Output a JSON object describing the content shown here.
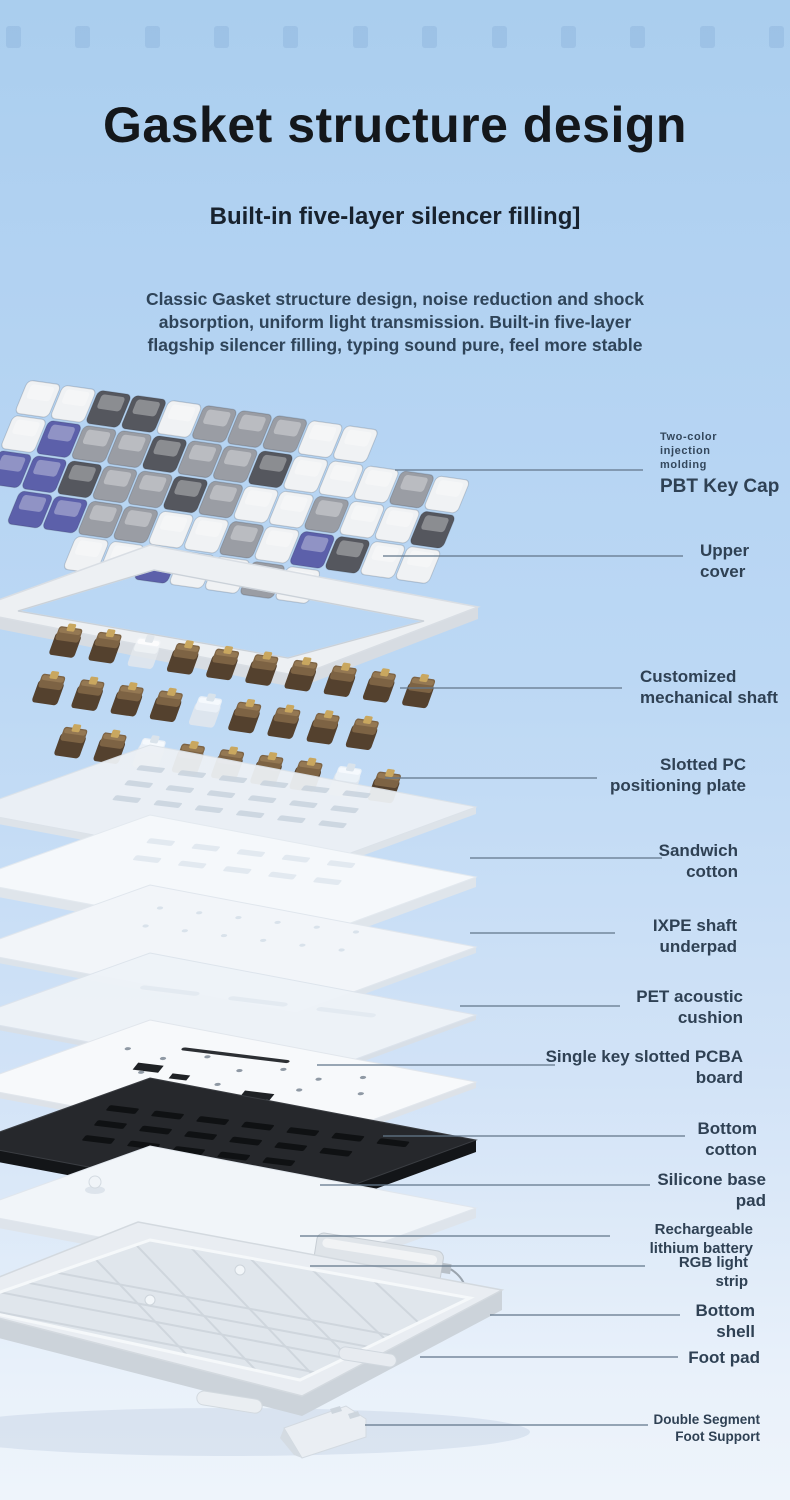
{
  "page": {
    "title": "Gasket structure design",
    "subtitle": "Built-in five-layer silencer filling]",
    "description": [
      "Classic Gasket structure design, noise reduction and shock",
      "absorption, uniform light transmission. Built-in five-layer",
      "flagship silencer filling, typing sound pure, feel more stable"
    ]
  },
  "diagram": {
    "subject": "Exploded view of gasket-mount mechanical keyboard layers",
    "callouts": [
      {
        "note": "Two-color\ninjection\nmolding",
        "text": "PBT Key Cap"
      },
      {
        "text": "Upper\ncover"
      },
      {
        "text": "Customized\nmechanical shaft"
      },
      {
        "text": "Slotted PC\npositioning plate"
      },
      {
        "text": "Sandwich\ncotton"
      },
      {
        "text": "IXPE shaft\nunderpad"
      },
      {
        "text": "PET acoustic\ncushion"
      },
      {
        "text": "Single key slotted PCBA\nboard"
      },
      {
        "text": "Bottom\ncotton"
      },
      {
        "text": "Silicone base\npad"
      },
      {
        "text": "Rechargeable\nlithium battery"
      },
      {
        "text": "RGB light\nstrip"
      },
      {
        "text": "Bottom\nshell"
      },
      {
        "text": "Foot pad"
      },
      {
        "text": "Double Segment\nFoot Support"
      }
    ]
  },
  "colors": {
    "background_top": "#aaceee",
    "background_bottom": "#eef4fb",
    "title_text": "#14171b",
    "body_text": "#2f4459",
    "label_text": "#2f4154",
    "leader_line": "#64788c",
    "keycap_white": "#f0f2f4",
    "keycap_gray": "#55575e",
    "keycap_purple": "#5c60aa",
    "switch_brown": "#7d6344",
    "switch_stem_gold": "#c9a75f",
    "bottom_cotton_black": "#26282c",
    "shell_white": "#e9edf2"
  }
}
